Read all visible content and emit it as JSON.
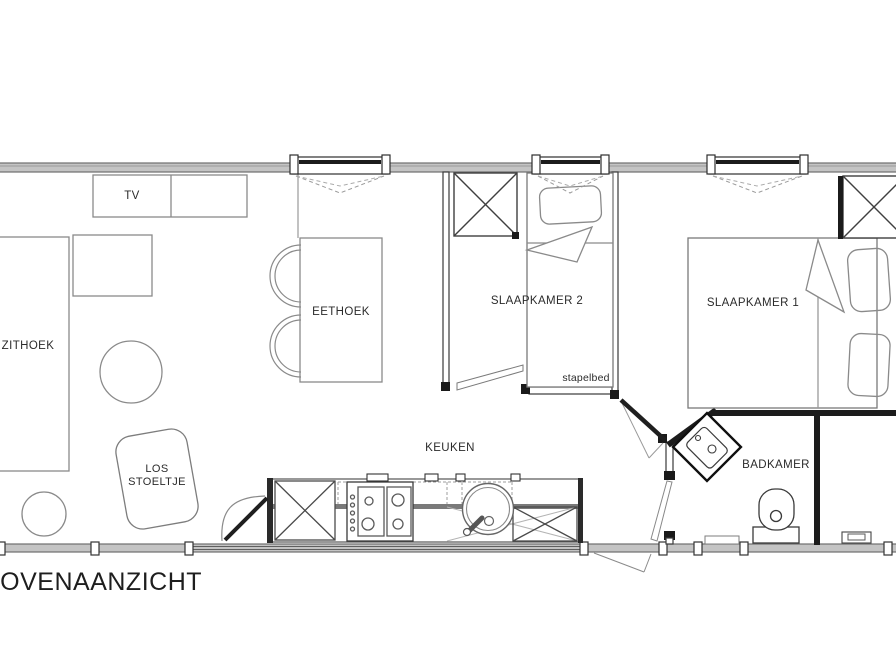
{
  "meta": {
    "view_label": "BOVENAANZICHT"
  },
  "rooms": {
    "zithoek": {
      "label": "ZITHOEK"
    },
    "eethoek": {
      "label": "EETHOEK"
    },
    "keuken": {
      "label": "KEUKEN"
    },
    "slaapkamer2": {
      "label": "SLAAPKAMER 2",
      "note": "stapelbed"
    },
    "slaapkamer1": {
      "label": "SLAAPKAMER 1"
    },
    "badkamer": {
      "label": "BADKAMER"
    }
  },
  "furniture": {
    "tv": {
      "label": "TV"
    },
    "los_stoeltje": {
      "label": "LOS STOELTJE"
    }
  },
  "colors": {
    "exterior_wall": "#c4c4c4",
    "wall_line": "#1c1c1c",
    "furniture_line": "#8a8a8a",
    "text": "#2b2b2b"
  }
}
